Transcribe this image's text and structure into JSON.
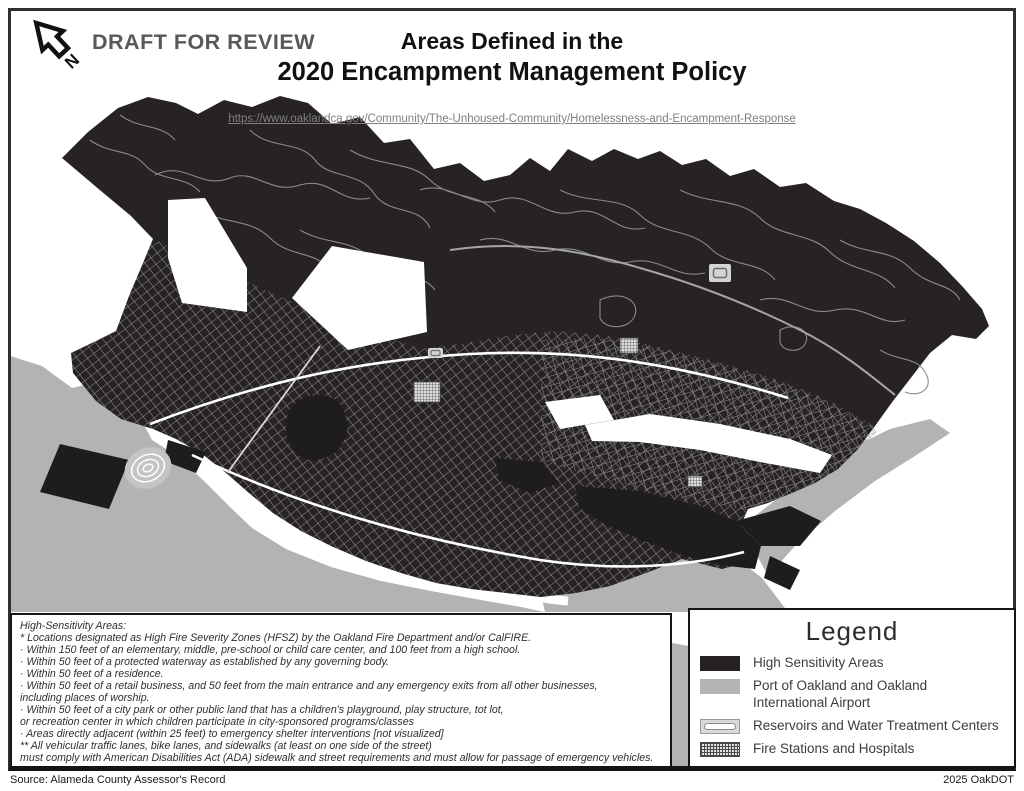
{
  "header": {
    "draft_label": "DRAFT FOR REVIEW",
    "title_line1": "Areas Defined in the",
    "title_line2": "2020 Encampment Management Policy",
    "url": "https://www.oaklandca.gov/Community/The-Unhoused-Community/Homelessness-and-Encampment-Response"
  },
  "map": {
    "colors": {
      "high_sensitivity": "#262223",
      "port_gray": "#b3b3b3",
      "street_gray": "#8f8f8f",
      "background": "#ffffff"
    }
  },
  "notes": {
    "lines": [
      "High-Sensitivity Areas:",
      "* Locations designated as High Fire Severity Zones (HFSZ) by the Oakland Fire Department and/or CalFIRE.",
      "· Within 150 feet of an elementary, middle, pre-school or child care center, and 100 feet from a high school.",
      "· Within 50 feet of a protected waterway as established by any governing body.",
      "· Within 50 feet of a residence.",
      "· Within 50 feet of a retail business, and 50 feet from the main entrance and any emergency exits from all other businesses,",
      "including places of worship.",
      "· Within 50 feet of a city park or other public land that has a children's playground, play structure, tot lot,",
      "or recreation center in which children participate in city-sponsored programs/classes",
      "· Areas directly adjacent (within 25 feet) to emergency shelter interventions [not visualized]",
      "** All vehicular traffic lanes, bike lanes, and sidewalks (at least on one side of the street)",
      "must comply with American Disabilities Act (ADA) sidewalk and street requirements and must allow for passage of emergency vehicles."
    ]
  },
  "legend": {
    "title": "Legend",
    "items": [
      {
        "label": "High Sensitivity Areas",
        "color": "#262223"
      },
      {
        "label": "Port of Oakland and Oakland International Airport",
        "color": "#b3b3b3"
      },
      {
        "label": "Reservoirs and Water Treatment Centers",
        "color": "#ffffff"
      },
      {
        "label": "Fire Stations and Hospitals",
        "color": "#4a4a4a"
      }
    ]
  },
  "footer": {
    "source": "Source: Alameda County Assessor's Record",
    "credit": "2025 OakDOT"
  }
}
